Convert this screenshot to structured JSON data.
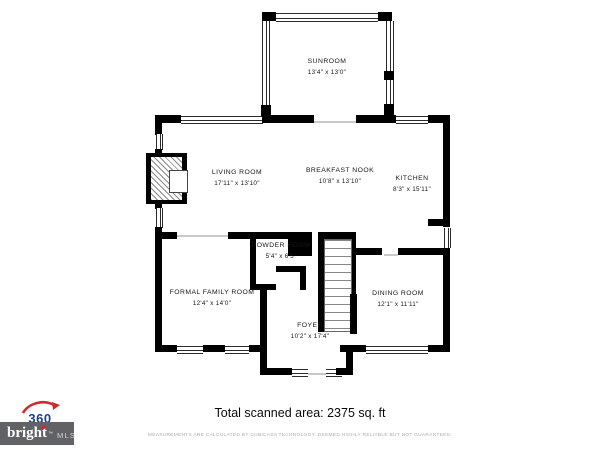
{
  "floorplan": {
    "rooms": {
      "sunroom": {
        "name": "SUNROOM",
        "dims": "13'4\" x 13'0\""
      },
      "living_room": {
        "name": "LIVING ROOM",
        "dims": "17'11\" x 13'10\""
      },
      "breakfast_nook": {
        "name": "BREAKFAST NOOK",
        "dims": "10'8\" x 13'10\""
      },
      "kitchen": {
        "name": "KITCHEN",
        "dims": "8'3\" x 15'11\""
      },
      "powder_room": {
        "name": "POWDER ROOM",
        "dims": "5'4\" x 6'5\""
      },
      "formal_family_room": {
        "name": "FORMAL FAMILY ROOM",
        "dims": "12'4\" x 14'0\""
      },
      "dining_room": {
        "name": "DINING ROOM",
        "dims": "12'1\" x 11'11\""
      },
      "foyer": {
        "name": "FOYER",
        "dims": "10'2\" x 17'4\""
      }
    }
  },
  "footer": {
    "total_area": "Total scanned area: 2375 sq. ft",
    "disclaimer": "MEASUREMENTS ARE CALCULATED BY CUBICASA TECHNOLOGY. DEEMED HIGHLY RELIABLE BUT NOT GUARANTEED."
  },
  "branding": {
    "logo_360": {
      "number": "360"
    },
    "bright_mls": {
      "word": "bright",
      "tm": "™",
      "mls": "MLS"
    }
  },
  "colors": {
    "wall": "#000000",
    "logo_blue": "#1d3d91",
    "logo_red": "#cf2a2a",
    "bright_gray": "#616265",
    "disclaimer_gray": "#ababab"
  }
}
